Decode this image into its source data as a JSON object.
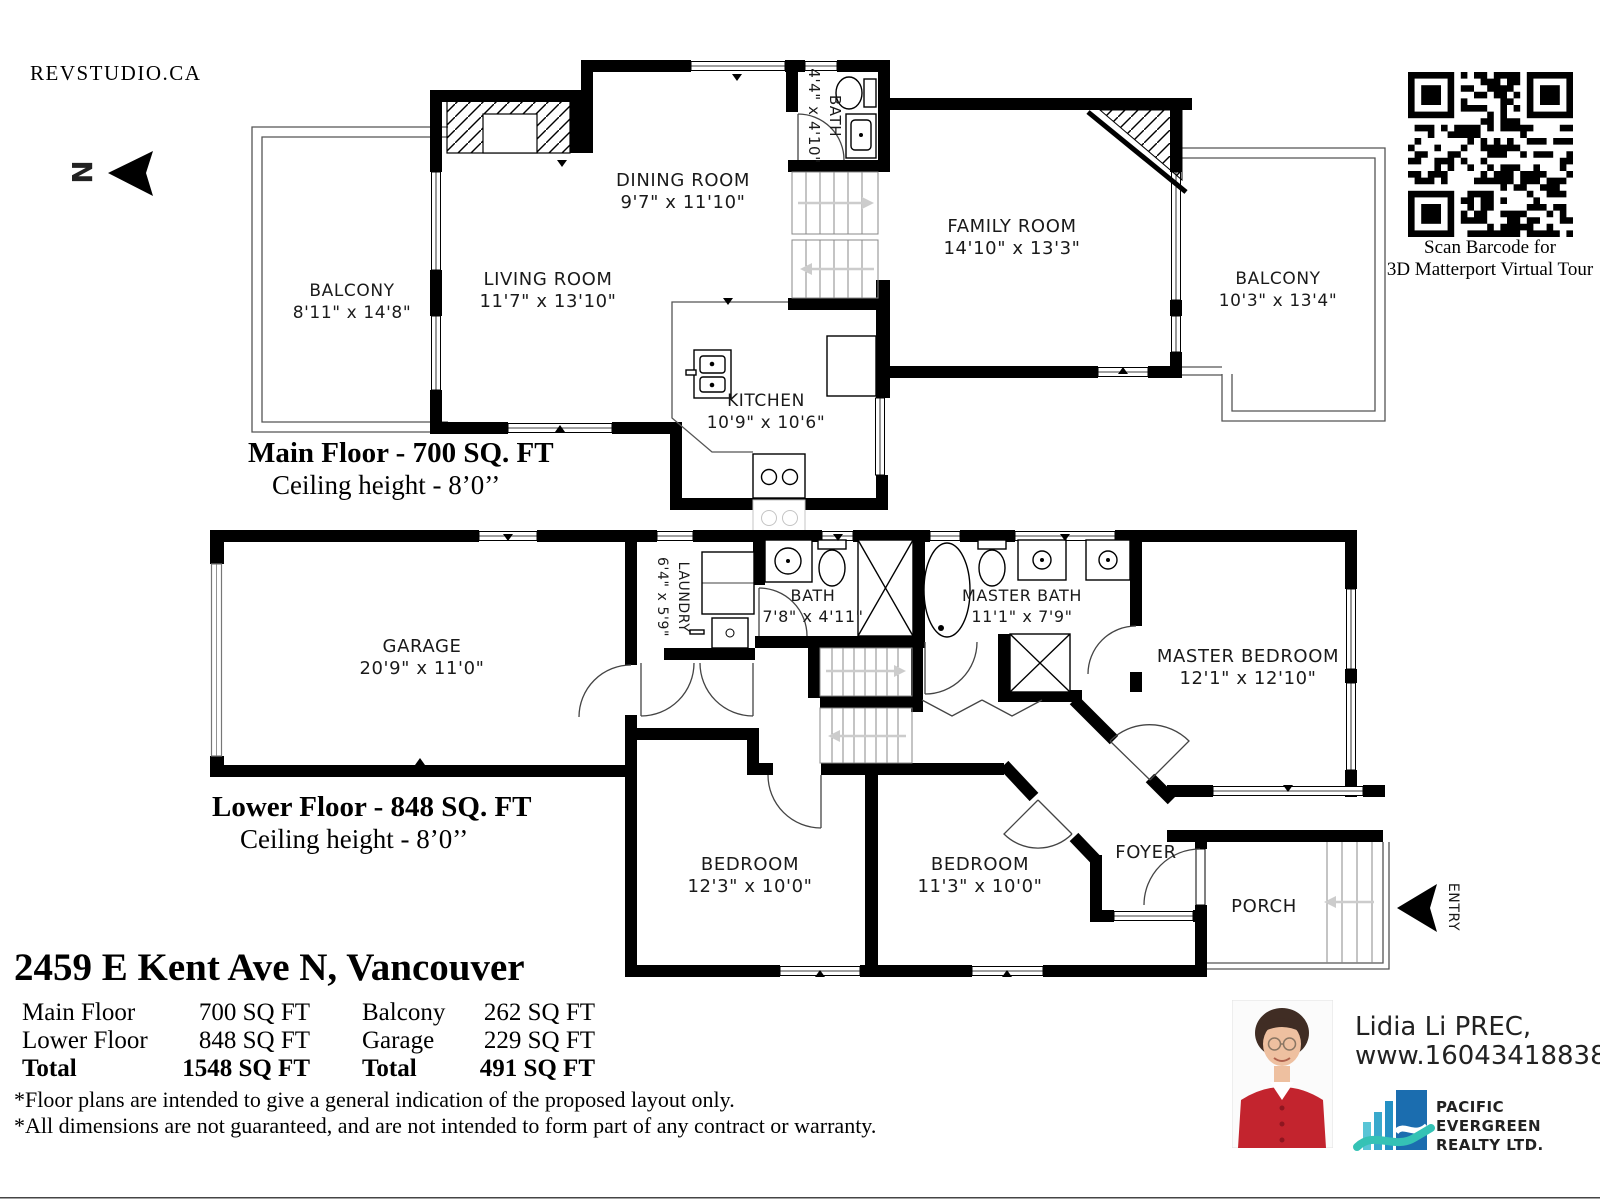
{
  "branding": {
    "studio": "REVSTUDIO.CA",
    "north_label": "N"
  },
  "qr": {
    "caption_line1": "Scan Barcode for",
    "caption_line2": "3D Matterport Virtual Tour"
  },
  "main_floor": {
    "title": "Main Floor - 700 SQ. FT",
    "ceiling": "Ceiling height - 8’0’’",
    "rooms": {
      "balcony_left": {
        "name": "BALCONY",
        "dims": "8'11\" x 14'8\""
      },
      "living": {
        "name": "LIVING ROOM",
        "dims": "11'7\" x 13'10\""
      },
      "dining": {
        "name": "DINING ROOM",
        "dims": "9'7\" x 11'10\""
      },
      "bath": {
        "name": "BATH",
        "dims": "4'4\" x 4'10\""
      },
      "family": {
        "name": "FAMILY ROOM",
        "dims": "14'10\" x 13'3\""
      },
      "balcony_right": {
        "name": "BALCONY",
        "dims": "10'3\" x 13'4\""
      },
      "kitchen": {
        "name": "KITCHEN",
        "dims": "10'9\" x 10'6\""
      }
    }
  },
  "lower_floor": {
    "title": "Lower Floor - 848 SQ. FT",
    "ceiling": "Ceiling height - 8’0’’",
    "rooms": {
      "garage": {
        "name": "GARAGE",
        "dims": "20'9\" x 11'0\""
      },
      "laundry": {
        "name": "LAUNDRY",
        "dims": "6'4\" x 5'9\""
      },
      "bath": {
        "name": "BATH",
        "dims": "7'8\" x 4'11\""
      },
      "master_bath": {
        "name": "MASTER BATH",
        "dims": "11'1\" x 7'9\""
      },
      "master_bedroom": {
        "name": "MASTER BEDROOM",
        "dims": "12'1\" x 12'10\""
      },
      "bedroom1": {
        "name": "BEDROOM",
        "dims": "12'3\" x 10'0\""
      },
      "bedroom2": {
        "name": "BEDROOM",
        "dims": "11'3\" x 10'0\""
      },
      "foyer": {
        "name": "FOYER"
      },
      "porch": {
        "name": "PORCH"
      },
      "entry": {
        "name": "ENTRY"
      }
    }
  },
  "summary": {
    "address": "2459 E Kent Ave N, Vancouver",
    "areas_left": [
      {
        "label": "Main Floor",
        "value": "700 SQ FT"
      },
      {
        "label": "Lower Floor",
        "value": "848 SQ FT"
      },
      {
        "label": "Total",
        "value": "1548 SQ FT"
      }
    ],
    "areas_right": [
      {
        "label": "Balcony",
        "value": "262 SQ FT"
      },
      {
        "label": "Garage",
        "value": "229 SQ FT"
      },
      {
        "label": "Total",
        "value": "491 SQ FT"
      }
    ],
    "disclaimer1": "*Floor plans are intended to give a general indication of the proposed layout only.",
    "disclaimer2": "*All dimensions are not guaranteed, and are not intended to form part of any contract or warranty."
  },
  "agent": {
    "name": "Lidia Li PREC,",
    "website": "www.16043418838.com"
  },
  "brokerage": {
    "line1": "PACIFIC",
    "line2": "EVERGREEN",
    "line3": "REALTY LTD.",
    "colors": {
      "line1": "#1b75bb",
      "line2": "#2cb5a2",
      "line3": "#115e86"
    }
  }
}
